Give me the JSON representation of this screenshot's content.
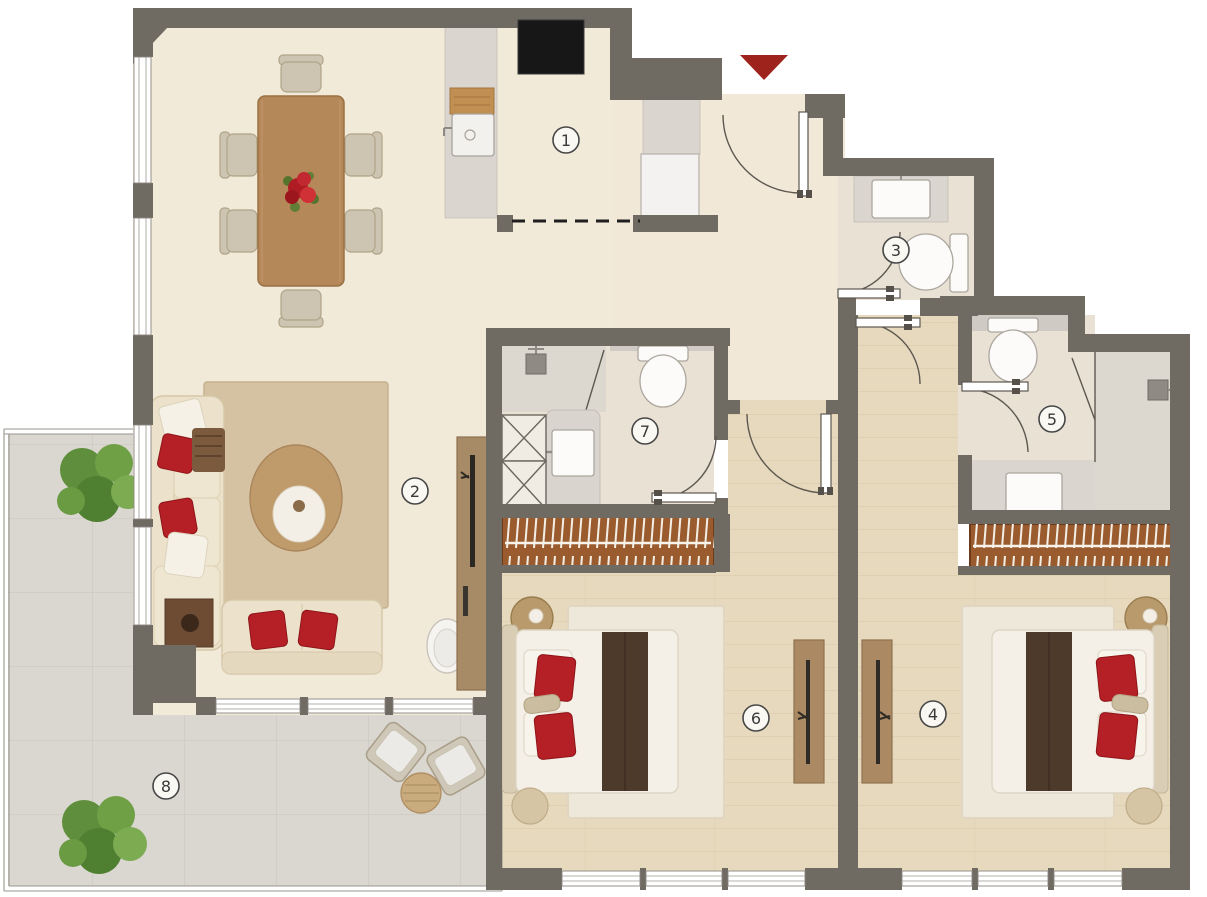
{
  "floorplan": {
    "title_present": false,
    "rooms": {
      "kitchen": {
        "number": "1"
      },
      "living_dining": {
        "number": "2"
      },
      "guest_bathroom": {
        "number": "3"
      },
      "bedroom_right": {
        "number": "4"
      },
      "bathroom_right": {
        "number": "5"
      },
      "bedroom_left": {
        "number": "6"
      },
      "bathroom_left": {
        "number": "7"
      },
      "terrace": {
        "number": "8"
      }
    },
    "colors": {
      "wall": "#6f6a62",
      "floor_cream": "#f2ead9",
      "floor_wood": "#e7d9bd",
      "floor_bath": "#e9e1d4",
      "floor_shower": "#dcd7cf",
      "floor_terrace": "#dad7d1",
      "closet_wood": "#9a5c2f",
      "accent_red": "#b42025",
      "entry_arrow": "#9e231c",
      "sofa_cream": "#ece2cb",
      "table_wood": "#b5885a"
    }
  }
}
